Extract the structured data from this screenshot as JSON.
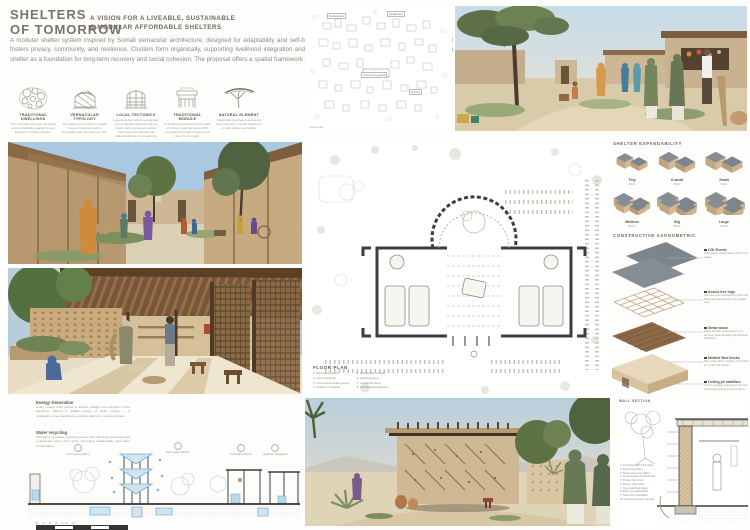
{
  "colors": {
    "title": "#7b7268",
    "sand": "#cdb795",
    "roof_gray": "#868e95",
    "accent_blue": "#76aecd",
    "wood": "#8d6847"
  },
  "board": {
    "title_line1": "SHELTERS",
    "title_line2": "OF TOMORROW",
    "subtitle_line1": "A VISION FOR A LIVEABLE, SUSTAINABLE",
    "subtitle_line2": "& MODULAR AFFORDABLE SHELTERS",
    "intro": "A modular shelter system inspired by Somali vernacular architecture, designed for adaptability and self-build. Using local materials and simple construction, it fosters privacy, community, and resilience. Clusters form organically, supporting livelihood integration and dignified living in displacement contexts reimagining shelter as a foundation for long-term recovery and social cohesion. The proposal offers a spatial framework that grows with its users, rooted in the somali culture."
  },
  "concepts": [
    {
      "label": "TRADITIONAL DWELLINGS",
      "caption": "The courtyard has been physically and symbolically adapted to new functions in shelter clusters."
    },
    {
      "label": "VERNACULAR TYPOLOGY",
      "caption": "The aqal is a permanent nomadic house of branches with a removable plan, and that can vary."
    },
    {
      "label": "LOCAL TECTONICS",
      "caption": "Local tectonics reflect a pragmatic use of natural materials such as wood, earth and woven textiles that respond to climate and cultural patterns of nomadic life."
    },
    {
      "label": "TRADITIONAL MODULE",
      "caption": "In traditional construction the width of a room could not exceed 350 cm without a wooden beam more than 4 m in length."
    },
    {
      "label": "NATURAL ELEMENT",
      "caption": "Acacia has long been used as an important tree in somali tradition to provide shelter and shade."
    }
  ],
  "masterplan": {
    "caption": "masterplan",
    "labels": [
      "Marketplace",
      "Healthcare",
      "Community space",
      "School"
    ]
  },
  "floor_plan": {
    "title": "FLOOR PLAN",
    "legend_col1": [
      "1. Bed living space",
      "2. Semi veranda",
      "3. Courtyard/cooking area",
      "4. Outdoor veranda"
    ],
    "legend_col2": [
      "5. Expanded module",
      "6. Farming area",
      "7. Livestock keep",
      "8. Livelihood/expansion"
    ]
  },
  "expandability": {
    "title": "SHELTER EXPANDABILITY",
    "modules": [
      {
        "name": "Tiny",
        "area": "24m²"
      },
      {
        "name": "X-small",
        "area": "40m²"
      },
      {
        "name": "Small",
        "area": "64m²"
      },
      {
        "name": "Medium",
        "area": "80m²"
      },
      {
        "name": "Big",
        "area": "96m²"
      },
      {
        "name": "Large",
        "area": "112m²"
      }
    ]
  },
  "axonometric": {
    "title": "CONSTRUCTIVE AXONOMETRIC",
    "layers": [
      {
        "name": "CGI Sheets",
        "desc": "Corrugated metal sheets with 2 mm edges"
      },
      {
        "name": "Acacia tree logs",
        "desc": "Cut tree logs intertwined to form the structural framework of the shelter roof"
      },
      {
        "name": "Straw wood",
        "desc": "Fitted slender sticks woven in a layered mesh assisting the thermal insulation"
      },
      {
        "name": "Molded Mud bricks",
        "desc": "Site-made 50cm molded mud bricks on a half-unit design"
      },
      {
        "name": "Ceiling jet stabilizer",
        "desc": "A 5 cm wooden logs tied to the roof framework acting as wind braces"
      }
    ]
  },
  "sustainability": {
    "energy_title": "Energy Generation",
    "energy_text": "Using rooftop solar panels to absorb sunlight and transform it into electricity, offering a reliable source of clean energy — a sustainable, low-maintenance solution tailored to remote shelters.",
    "water_title": "Water recycling",
    "water_text": "Through a greywater recycling system that effectively processes and re-purposes water from sinks, promoting sustainability and water conservation.",
    "icons": [
      "Communal cooking",
      "Rain water collector",
      "Rainwater filtered",
      "Livelihood integration"
    ],
    "scale_label": "0 1 2 5 10 m"
  },
  "wall_section": {
    "title": "WALL SECTION",
    "notes": [
      "1. CGI sheet with 2.5% slope",
      "2. Acacia log rafters",
      "3. Straw wood mat ceiling",
      "4. Compressed mud brick wall",
      "5. Timber door lintel",
      "6. Woven shelf niche",
      "7. Lime stabilized plaster",
      "8. Earth compacted floor",
      "9. Stone strip foundation",
      "10. Compacted gravel ground"
    ]
  }
}
